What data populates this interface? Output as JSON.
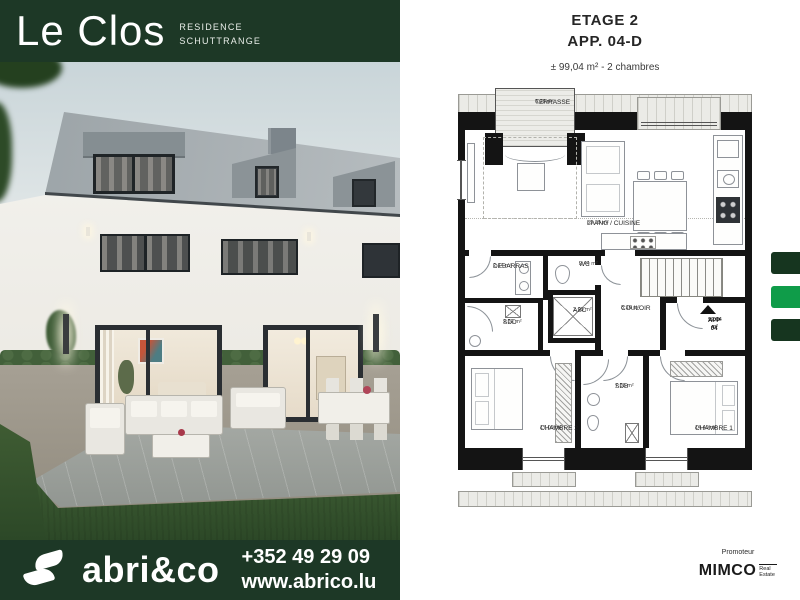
{
  "header": {
    "title": "Le Clos",
    "residence": "RESIDENCE",
    "location": "SCHUTTRANGE"
  },
  "plan_header": {
    "floor": "ETAGE 2",
    "unit": "APP. 04-D",
    "details": "± 99,04 m² - 2 chambres"
  },
  "floorplan": {
    "rooms": [
      {
        "name": "TERRASSE",
        "area": "6,29 m²"
      },
      {
        "name": "LIVING / CUISINE",
        "area": "39,19 m²"
      },
      {
        "name": "DEBARRAS",
        "area": "2,14 m²"
      },
      {
        "name": "WC",
        "area": "2,44 m²"
      },
      {
        "name": "SDD",
        "area": "2,52 m²"
      },
      {
        "name": "ASC",
        "area": "2,99 m²"
      },
      {
        "name": "COULOIR",
        "area": "8,16 m²"
      },
      {
        "name": "CHAMBRE 2",
        "area": "17,00 m²"
      },
      {
        "name": "SDB",
        "area": "7,53 m²"
      },
      {
        "name": "CHAMBRE 1",
        "area": "14,40 m²"
      }
    ],
    "unit_marker": {
      "label": "APP 04",
      "area": "99,04 m²"
    }
  },
  "footer": {
    "brand": "abri&co",
    "phone": "+352 49 29 09",
    "website": "www.abrico.lu"
  },
  "promoter": {
    "label": "Promoteur",
    "name": "MIMCO",
    "tagline": "Real Estate"
  },
  "colors": {
    "brand_green": "#1d3826",
    "accent_green": "#0f9c49",
    "inactive_green": "#16351f"
  }
}
